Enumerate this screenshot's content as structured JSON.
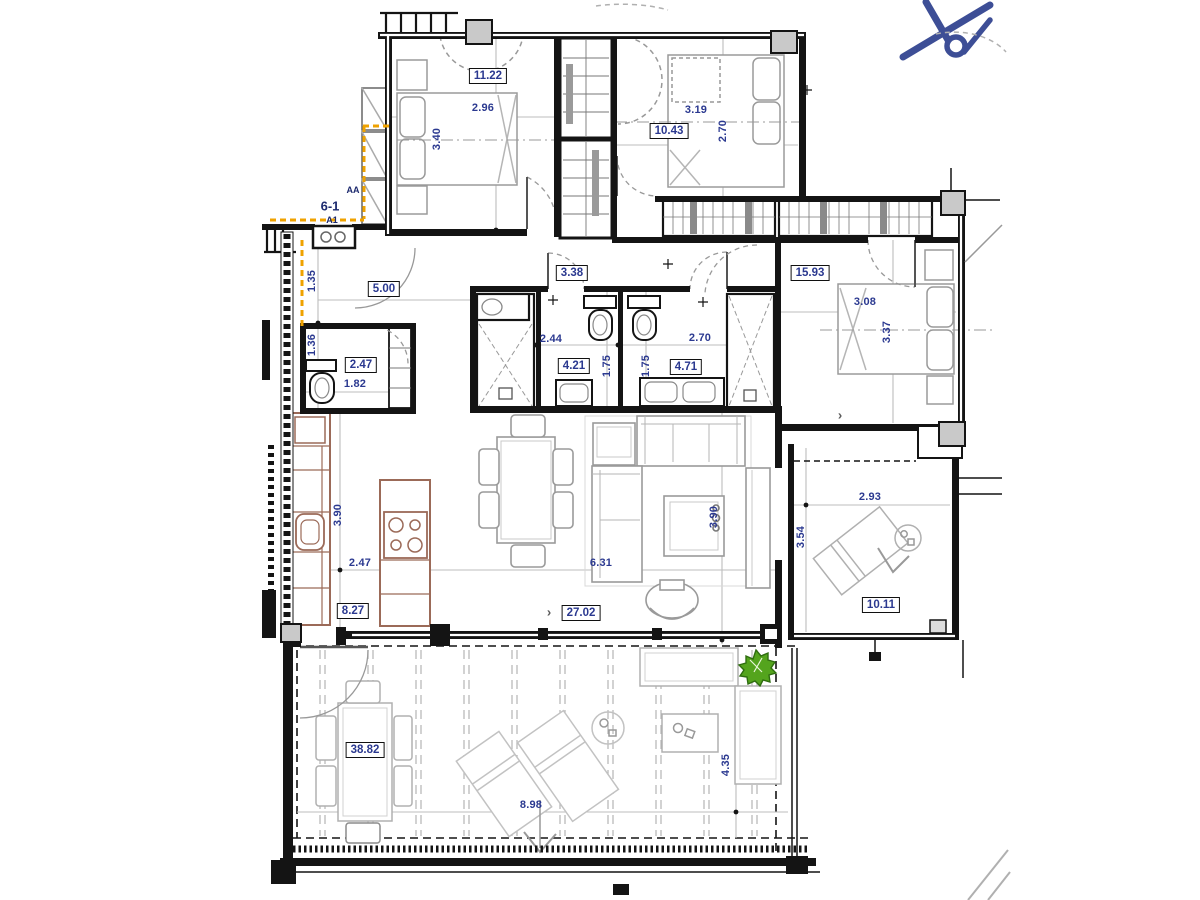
{
  "annotations": {
    "section_mark": "AA",
    "unit_mark": "6-1",
    "unit_submark": "A1"
  },
  "area_labels": [
    {
      "name": "bedroom-1",
      "value": "11.22"
    },
    {
      "name": "bedroom-2",
      "value": "10.43"
    },
    {
      "name": "master-bedroom",
      "value": "15.93"
    },
    {
      "name": "hall",
      "value": "5.00"
    },
    {
      "name": "corridor",
      "value": "3.38"
    },
    {
      "name": "guest-wc",
      "value": "2.47"
    },
    {
      "name": "bathroom-1",
      "value": "4.21"
    },
    {
      "name": "bathroom-2",
      "value": "4.71"
    },
    {
      "name": "kitchen",
      "value": "8.27"
    },
    {
      "name": "living-room",
      "value": "27.02"
    },
    {
      "name": "side-terrace",
      "value": "10.11"
    },
    {
      "name": "main-terrace",
      "value": "38.82"
    }
  ],
  "dimension_labels": [
    {
      "name": "bedroom-1-width",
      "value": "2.96",
      "orientation": "h"
    },
    {
      "name": "bedroom-1-depth",
      "value": "3.40",
      "orientation": "v"
    },
    {
      "name": "bedroom-2-width",
      "value": "3.19",
      "orientation": "h"
    },
    {
      "name": "bedroom-2-depth",
      "value": "2.70",
      "orientation": "v"
    },
    {
      "name": "master-width",
      "value": "3.08",
      "orientation": "h"
    },
    {
      "name": "master-depth",
      "value": "3.37",
      "orientation": "v"
    },
    {
      "name": "entry-width",
      "value": "1.35",
      "orientation": "v"
    },
    {
      "name": "wc-width",
      "value": "1.36",
      "orientation": "v"
    },
    {
      "name": "wc-depth",
      "value": "1.82",
      "orientation": "h"
    },
    {
      "name": "bath-1-width",
      "value": "2.44",
      "orientation": "h"
    },
    {
      "name": "bath-1-depth",
      "value": "1.75",
      "orientation": "v"
    },
    {
      "name": "bath-2-depth",
      "value": "1.75",
      "orientation": "v"
    },
    {
      "name": "bath-2-width",
      "value": "2.70",
      "orientation": "h"
    },
    {
      "name": "kitchen-depth",
      "value": "3.90",
      "orientation": "v"
    },
    {
      "name": "kitchen-width",
      "value": "2.47",
      "orientation": "h"
    },
    {
      "name": "living-width",
      "value": "6.31",
      "orientation": "h"
    },
    {
      "name": "living-depth",
      "value": "3.90",
      "orientation": "v"
    },
    {
      "name": "side-terrace-width",
      "value": "2.93",
      "orientation": "h"
    },
    {
      "name": "side-terrace-depth",
      "value": "3.54",
      "orientation": "v"
    },
    {
      "name": "terrace-width",
      "value": "8.98",
      "orientation": "h"
    },
    {
      "name": "terrace-depth",
      "value": "4.35",
      "orientation": "v"
    }
  ],
  "markers": {
    "living_arrow": "›",
    "master_arrow": "›"
  },
  "icons": {
    "north_arrow": "north-arrow-icon",
    "plant": "plant-icon"
  },
  "colors": {
    "wall": "#141414",
    "furniture_gray": "#9a9a9a",
    "kitchen_brown": "#9b6a58",
    "label_text": "#2b3990",
    "boundary_orange": "#efa200",
    "plant_green": "#54a41d",
    "compass_blue": "#3d4e96"
  }
}
